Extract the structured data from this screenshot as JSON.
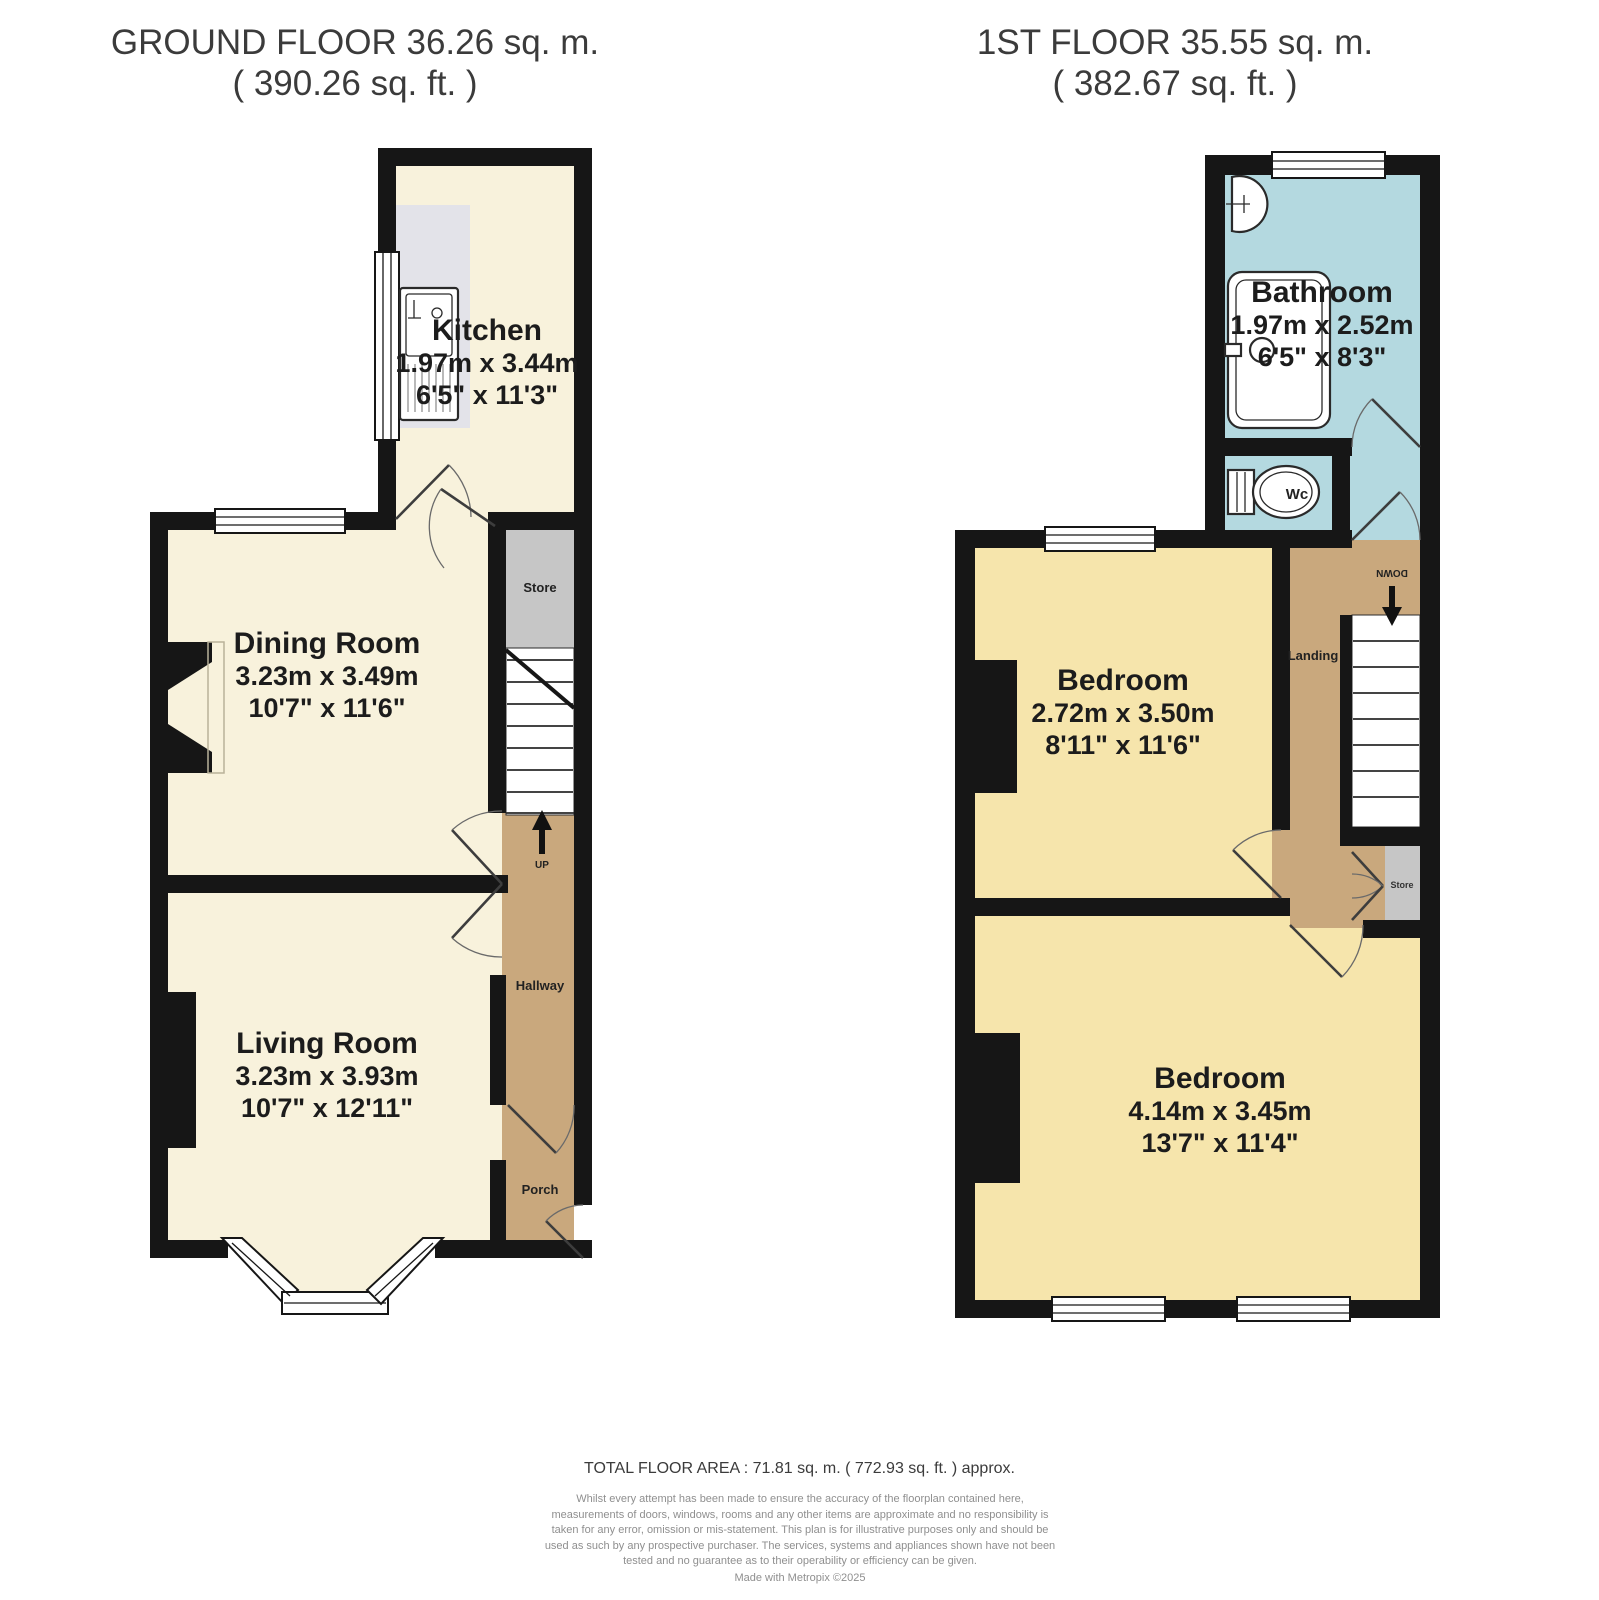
{
  "floors": {
    "ground": {
      "title": "GROUND FLOOR 36.26 sq. m.",
      "subtitle": "( 390.26 sq. ft. )",
      "rooms": {
        "kitchen": {
          "name": "Kitchen",
          "metric": "1.97m x 3.44m",
          "imperial": "6'5\" x 11'3\""
        },
        "dining_room": {
          "name": "Dining Room",
          "metric": "3.23m x 3.49m",
          "imperial": "10'7\" x 11'6\""
        },
        "living_room": {
          "name": "Living Room",
          "metric": "3.23m x 3.93m",
          "imperial": "10'7\" x 12'11\""
        },
        "store": {
          "name": "Store"
        },
        "hallway": {
          "name": "Hallway"
        },
        "porch": {
          "name": "Porch"
        }
      },
      "stairs_label": "UP"
    },
    "first": {
      "title": "1ST FLOOR 35.55 sq. m.",
      "subtitle": "( 382.67 sq. ft. )",
      "rooms": {
        "bathroom": {
          "name": "Bathroom",
          "metric": "1.97m x 2.52m",
          "imperial": "6'5\" x 8'3\""
        },
        "bedroom_front": {
          "name": "Bedroom",
          "metric": "2.72m x 3.50m",
          "imperial": "8'11\" x 11'6\""
        },
        "bedroom_back": {
          "name": "Bedroom",
          "metric": "4.14m x 3.45m",
          "imperial": "13'7\" x 11'4\""
        },
        "landing": {
          "name": "Landing"
        },
        "store": {
          "name": "Store"
        },
        "wc": {
          "name": "Wc"
        }
      },
      "stairs_label": "DOWN"
    }
  },
  "footer": {
    "total_area": "TOTAL FLOOR AREA : 71.81 sq. m. ( 772.93 sq. ft. ) approx.",
    "disclaimer": "Whilst every attempt has been made to ensure the accuracy of the floorplan contained here, measurements of doors, windows, rooms and any other items are approximate and no responsibility is taken for any error, omission or mis-statement. This plan is for illustrative purposes only and should be used as such by any prospective purchaser. The services, systems and appliances shown have not been tested and no guarantee as to their operability or efficiency can be given.",
    "credit": "Made with Metropix ©2025"
  },
  "colors": {
    "cream": "#f8f2dc",
    "gold": "#f6e5ac",
    "blue": "#b4d9e0",
    "tan": "#c9a87d",
    "store_gray": "#c6c6c6",
    "counter_gray": "#e3e3e9",
    "wall": "#161616"
  }
}
